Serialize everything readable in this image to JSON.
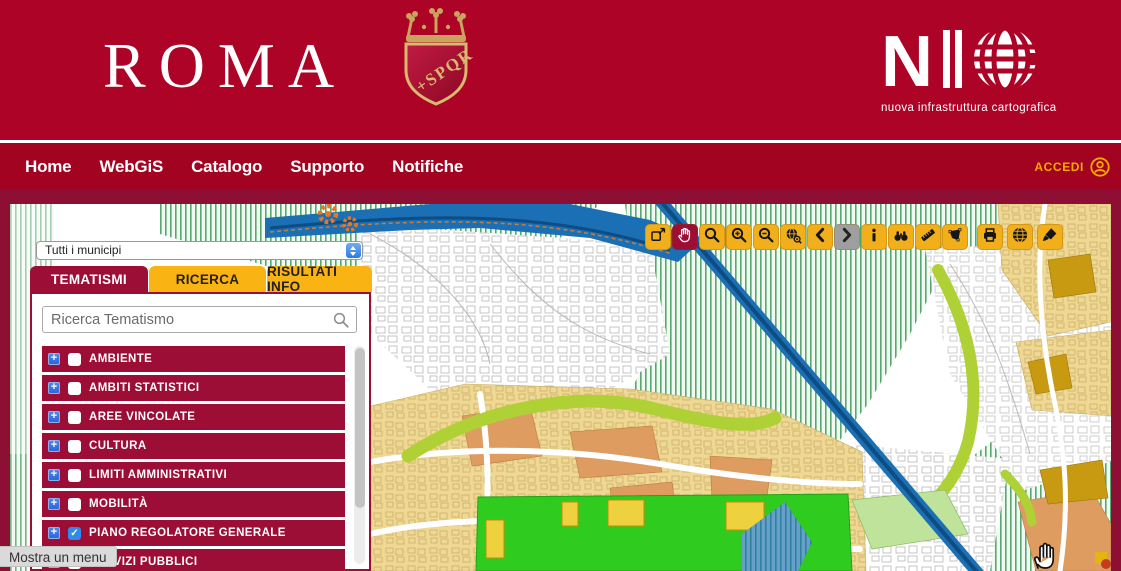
{
  "theme": {
    "header_bg": "#AC0326",
    "nav_bg": "#A10321",
    "frame_bg": "#8D1034",
    "row_red": "#9C0E36",
    "tab_yellow": "#F9B313",
    "tool_yellow": "#F2AF1C",
    "accent_yellow": "#F7A800",
    "disabled_gray": "#9F9F9F",
    "map_colors": {
      "urban_tan": "#EFD794",
      "urban_orange": "#DE9C60",
      "urban_mustard": "#C79A12",
      "green_hatch": "#55A86F",
      "park_green": "#2FCB1F",
      "lime_band": "#AFD135",
      "river_blue": "#1B6FB4",
      "river_core": "#0E4C82",
      "pale_green": "#BFE39A"
    }
  },
  "header": {
    "wordmark": "ROMA",
    "crest_text": "+SPQR",
    "logo": {
      "n": "N",
      "text": "NIC",
      "subtitle": "nuova infrastruttura cartografica"
    }
  },
  "nav": {
    "items": [
      {
        "label": "Home"
      },
      {
        "label": "WebGiS"
      },
      {
        "label": "Catalogo"
      },
      {
        "label": "Supporto"
      },
      {
        "label": "Notifiche"
      }
    ],
    "login": {
      "label": "ACCEDI",
      "icon": "user-circle-icon"
    }
  },
  "toolbar": {
    "groups": [
      {
        "name": "map-tools",
        "buttons": [
          {
            "name": "toggle-size",
            "icon": "expand-icon",
            "state": "normal"
          },
          {
            "name": "pan",
            "icon": "hand-icon",
            "state": "active"
          },
          {
            "name": "zoom-window",
            "icon": "zoom-icon",
            "state": "normal"
          },
          {
            "name": "zoom-in",
            "icon": "zoom-in-icon",
            "state": "normal"
          },
          {
            "name": "zoom-out",
            "icon": "zoom-out-icon",
            "state": "normal"
          },
          {
            "name": "full-extent",
            "icon": "full-extent-icon",
            "state": "normal"
          },
          {
            "name": "previous-extent",
            "icon": "chevron-left-icon",
            "state": "normal"
          },
          {
            "name": "next-extent",
            "icon": "chevron-right-icon",
            "state": "disabled"
          },
          {
            "name": "identify",
            "icon": "info-icon",
            "state": "normal"
          },
          {
            "name": "find",
            "icon": "binoculars-icon",
            "state": "normal"
          },
          {
            "name": "measure",
            "icon": "ruler-icon",
            "state": "normal"
          },
          {
            "name": "select-area",
            "icon": "polygon-icon",
            "state": "normal"
          }
        ]
      },
      {
        "name": "output-tools",
        "buttons": [
          {
            "name": "print",
            "icon": "printer-icon",
            "state": "normal"
          },
          {
            "name": "globe",
            "icon": "globe-grid-icon",
            "state": "normal"
          },
          {
            "name": "style-brush",
            "icon": "brush-icon",
            "state": "normal"
          }
        ]
      }
    ]
  },
  "panel": {
    "municipality_select": {
      "value": "Tutti i municipi"
    },
    "tabs": [
      {
        "label": "TEMATISMI",
        "active": true
      },
      {
        "label": "RICERCA",
        "active": false
      },
      {
        "label": "RISULTATI INFO",
        "active": false
      }
    ],
    "search": {
      "placeholder": "Ricerca Tematismo"
    },
    "layers": [
      {
        "label": "AMBIENTE",
        "checked": false
      },
      {
        "label": "AMBITI STATISTICI",
        "checked": false
      },
      {
        "label": "AREE VINCOLATE",
        "checked": false
      },
      {
        "label": "CULTURA",
        "checked": false
      },
      {
        "label": "LIMITI AMMINISTRATIVI",
        "checked": false
      },
      {
        "label": "MOBILITÀ",
        "checked": false
      },
      {
        "label": "PIANO REGOLATORE GENERALE",
        "checked": true
      },
      {
        "label": "SERVIZI PUBBLICI",
        "checked": false
      }
    ]
  },
  "tooltip": {
    "label": "Mostra un menu"
  }
}
